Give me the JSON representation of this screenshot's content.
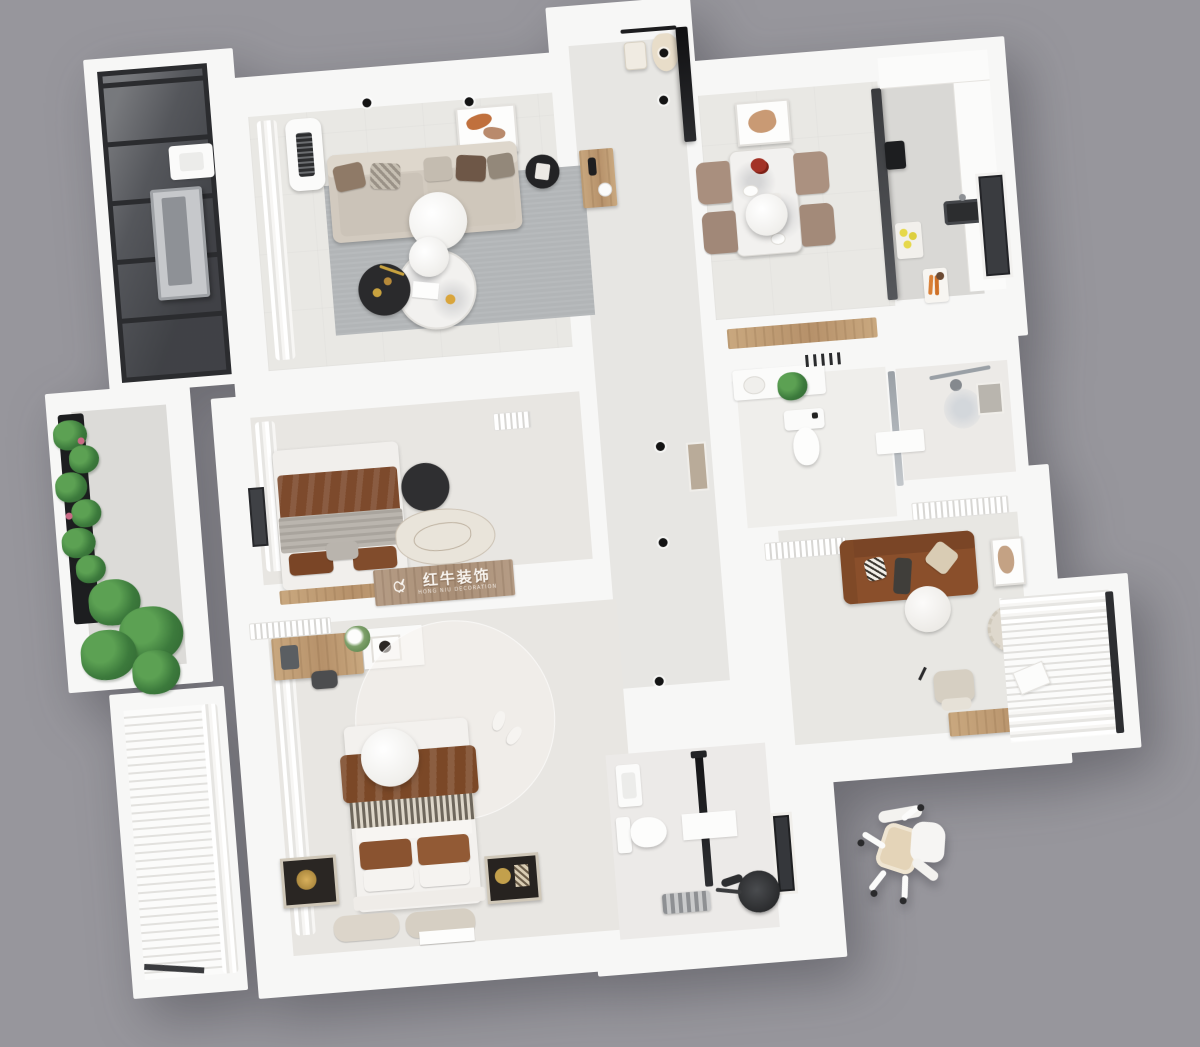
{
  "scene": {
    "type": "3d-apartment-floorplan-top-view",
    "background_color": "#97969c"
  },
  "watermark": {
    "icon": "bull-icon",
    "text": "红牛装饰",
    "subtext": "HONG NIU DECORATION",
    "panel_color": "#b59c85",
    "text_color": "#f8f4ef"
  },
  "palette": {
    "wall_white": "#f7f7f6",
    "floor_light": "#e9e8e4",
    "floor_tile_gray": "#d9d8d5",
    "rug_gray": "#b2b5b7",
    "sofa_beige": "#d2cabf",
    "sofa_brown": "#8a4f2b",
    "blanket_brown": "#7b4827",
    "wood_tan": "#c9a87f",
    "plant_green": "#3c7a3c",
    "glass_dark": "#4a4c51",
    "accent_black": "#1c1c1e",
    "lemon_yellow": "#e6d84a",
    "flower_red": "#a33226"
  },
  "rooms": [
    {
      "id": "living-room",
      "furniture": [
        "fabric-sofa",
        "throw-pillows",
        "gray-rug",
        "pendant-lamp",
        "marble-coffee-table",
        "black-side-table",
        "floor-ac-unit",
        "wall-art",
        "sheer-curtains",
        "ceiling-spotlights"
      ]
    },
    {
      "id": "entry-hall",
      "furniture": [
        "coat-rack",
        "hanging-coat",
        "hand-bag",
        "wood-console",
        "tv-panel",
        "wall-niche",
        "ceiling-spotlights"
      ]
    },
    {
      "id": "dining-room",
      "furniture": [
        "marble-dining-table",
        "dining-chairs",
        "pendant-lamp",
        "red-flowers",
        "wall-art",
        "wood-sideboard"
      ]
    },
    {
      "id": "kitchen",
      "furniture": [
        "glass-partition",
        "counters",
        "black-sink",
        "window",
        "coffee-machine",
        "lemons",
        "cutting-board-carrots"
      ]
    },
    {
      "id": "bathroom-main",
      "furniture": [
        "vanity-counter",
        "toilet",
        "potted-plant",
        "towel-rack",
        "shower-set",
        "glass-screen",
        "storage-niche"
      ]
    },
    {
      "id": "bedroom-second",
      "furniture": [
        "double-bed",
        "brown-blanket",
        "gray-quilt",
        "pillows",
        "black-round-rug",
        "art-rug",
        "wall-ac-unit",
        "curtains",
        "window",
        "watermark-headboard"
      ]
    },
    {
      "id": "master-bedroom",
      "furniture": [
        "double-bed",
        "brown-blanket",
        "herringbone-throw",
        "pillows",
        "floor-cushions",
        "leaning-art-frames",
        "pendant-lamp",
        "round-rug",
        "slippers",
        "desk",
        "desk-chair",
        "flowers",
        "white-sideboard",
        "wall-ac-unit",
        "curtains",
        "floor-photo"
      ]
    },
    {
      "id": "bathroom-second",
      "furniture": [
        "toilet",
        "wash-sink",
        "shower-column",
        "mirror-panel",
        "exercise-bike",
        "towel-basket",
        "window"
      ]
    },
    {
      "id": "study-room",
      "furniture": [
        "brown-sofa",
        "throw-pillows",
        "round-side-table",
        "office-chair",
        "wood-desk",
        "fluffy-pouf",
        "leaning-art-frame",
        "ceiling-ac-units"
      ]
    },
    {
      "id": "bay-window-study",
      "furniture": [
        "roman-blinds",
        "curtains",
        "book",
        "window-frame"
      ]
    },
    {
      "id": "balcony-laundry",
      "furniture": [
        "glazed-window-wall",
        "laundry-sink",
        "drying-rack"
      ]
    },
    {
      "id": "balcony-garden",
      "furniture": [
        "planter-box",
        "monstera-plants",
        "flowering-plants"
      ]
    },
    {
      "id": "bay-window-master",
      "furniture": [
        "shutter-blinds",
        "curtains"
      ]
    },
    {
      "id": "exterior",
      "furniture": [
        "stray-office-chair"
      ]
    }
  ]
}
